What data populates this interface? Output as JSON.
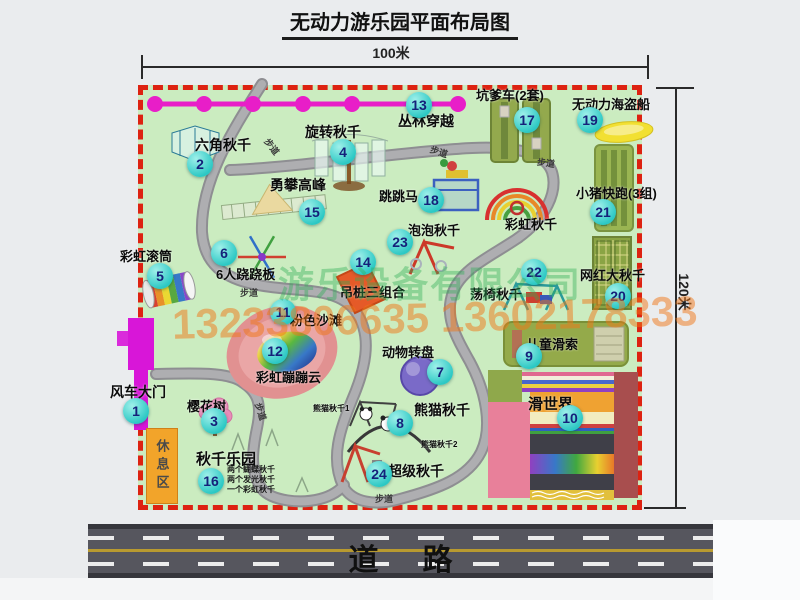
{
  "title": "无动力游乐园平面布局图",
  "dimensions": {
    "top": "100米",
    "right": "120米"
  },
  "road": {
    "label": "道路"
  },
  "rest_area": {
    "label": "休息区"
  },
  "watermark": {
    "company": "游乐设备有限公司",
    "phone": "13233806635 13602178333"
  },
  "walk_label_text": "步道",
  "colors": {
    "map_green": "#cbecc0",
    "border_red": "#dd2211",
    "badge_teal": "#2cc8c4",
    "badge_text_navy": "#15217a",
    "jungle_line_magenta": "#e81ec8",
    "gate_magenta": "#d816d8",
    "road_gray": "#56565e",
    "lane_yellow": "#b89a30",
    "rest_area_orange": "#f2a42a",
    "watermark_orange": "#f07818",
    "watermark_green": "#2fae57",
    "path_gray": "#9b9b9f"
  },
  "attractions": [
    {
      "num": 1,
      "label": "风车大门",
      "bx": 136,
      "by": 411,
      "lx": 110,
      "ly": 382,
      "fs": 14
    },
    {
      "num": 2,
      "label": "六角秋千",
      "bx": 200,
      "by": 164,
      "lx": 195,
      "ly": 135,
      "fs": 14
    },
    {
      "num": 3,
      "label": "樱花树",
      "bx": 214,
      "by": 421,
      "lx": 187,
      "ly": 396,
      "fs": 13
    },
    {
      "num": 4,
      "label": "旋转秋千",
      "bx": 343,
      "by": 152,
      "lx": 305,
      "ly": 122,
      "fs": 14
    },
    {
      "num": 5,
      "label": "彩虹滚筒",
      "bx": 160,
      "by": 276,
      "lx": 120,
      "ly": 246,
      "fs": 13
    },
    {
      "num": 6,
      "label": "6人跷跷板",
      "bx": 224,
      "by": 253,
      "lx": 216,
      "ly": 264,
      "fs": 13
    },
    {
      "num": 7,
      "label": "动物转盘",
      "bx": 440,
      "by": 372,
      "lx": 382,
      "ly": 342,
      "fs": 13
    },
    {
      "num": 8,
      "label": "熊猫秋千",
      "bx": 400,
      "by": 423,
      "lx": 414,
      "ly": 400,
      "fs": 14
    },
    {
      "num": 9,
      "label": "儿童滑索",
      "bx": 529,
      "by": 356,
      "lx": 526,
      "ly": 334,
      "fs": 13
    },
    {
      "num": 10,
      "label": "滑世界",
      "bx": 570,
      "by": 418,
      "lx": 528,
      "ly": 393,
      "fs": 15
    },
    {
      "num": 11,
      "label": "粉色沙滩",
      "bx": 283,
      "by": 312,
      "lx": 290,
      "ly": 310,
      "fs": 13
    },
    {
      "num": 12,
      "label": "彩虹蹦蹦云",
      "bx": 275,
      "by": 351,
      "lx": 256,
      "ly": 367,
      "fs": 13
    },
    {
      "num": 13,
      "label": "丛林穿越",
      "bx": 419,
      "by": 105,
      "lx": 398,
      "ly": 111,
      "fs": 14
    },
    {
      "num": 14,
      "label": "吊桩三组合",
      "bx": 363,
      "by": 262,
      "lx": 340,
      "ly": 282,
      "fs": 13
    },
    {
      "num": 15,
      "label": "勇攀高峰",
      "bx": 312,
      "by": 212,
      "lx": 270,
      "ly": 175,
      "fs": 14
    },
    {
      "num": 16,
      "label": "秋千乐园",
      "bx": 211,
      "by": 481,
      "lx": 196,
      "ly": 448,
      "fs": 15
    },
    {
      "num": 17,
      "label": "坑爹车(2套)",
      "bx": 527,
      "by": 120,
      "lx": 476,
      "ly": 85,
      "fs": 13
    },
    {
      "num": 18,
      "label": "跳跳马",
      "bx": 431,
      "by": 200,
      "lx": 379,
      "ly": 186,
      "fs": 13
    },
    {
      "num": 19,
      "label": "无动力海盗船",
      "bx": 590,
      "by": 120,
      "lx": 572,
      "ly": 94,
      "fs": 13
    },
    {
      "num": 20,
      "label": "网红大秋千",
      "bx": 618,
      "by": 296,
      "lx": 580,
      "ly": 265,
      "fs": 13
    },
    {
      "num": 21,
      "label": "小猪快跑(3组)",
      "bx": 603,
      "by": 212,
      "lx": 576,
      "ly": 183,
      "fs": 13
    },
    {
      "num": 22,
      "label": "荡椅秋千",
      "bx": 534,
      "by": 272,
      "lx": 470,
      "ly": 284,
      "fs": 13
    },
    {
      "num": 23,
      "label": "泡泡秋千",
      "bx": 400,
      "by": 242,
      "lx": 408,
      "ly": 220,
      "fs": 13
    },
    {
      "num": 24,
      "label": "超级秋千",
      "bx": 379,
      "by": 474,
      "lx": 388,
      "ly": 461,
      "fs": 14
    }
  ],
  "small_labels": [
    {
      "text": "彩虹秋千",
      "x": 505,
      "y": 214,
      "fs": 13
    },
    {
      "text": "熊猫秋千1",
      "x": 313,
      "y": 403,
      "fs": 8
    },
    {
      "text": "熊猫秋千2",
      "x": 421,
      "y": 439,
      "fs": 8
    }
  ],
  "walk_labels": [
    {
      "x": 263,
      "y": 140,
      "rot": 52
    },
    {
      "x": 430,
      "y": 145,
      "rot": 18
    },
    {
      "x": 537,
      "y": 156,
      "rot": 8
    },
    {
      "x": 240,
      "y": 286,
      "rot": 0
    },
    {
      "x": 252,
      "y": 405,
      "rot": 72
    },
    {
      "x": 375,
      "y": 492,
      "rot": 0
    }
  ],
  "swing_notes": [
    "两个蝴蝶秋千",
    "两个发光秋千",
    "一个彩虹秋千"
  ]
}
